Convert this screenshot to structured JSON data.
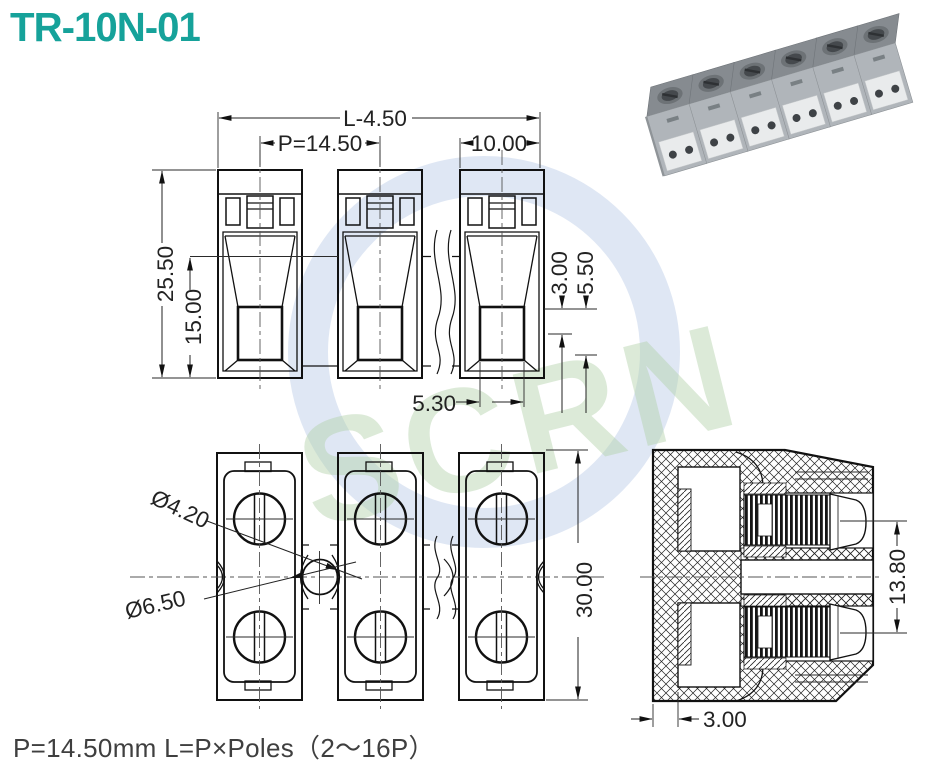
{
  "title": "TR-10N-01",
  "footer_note": "P=14.50mm  L=P×Poles（2～16P）",
  "watermark": {
    "text": "SCRN"
  },
  "front_view": {
    "dim_total_length": "L-4.50",
    "dim_pitch": "P=14.50",
    "dim_block_width": "10.00",
    "dim_overall_height": "25.50",
    "dim_body_height": "15.00",
    "dim_offset_a": "3.00",
    "dim_offset_b": "5.50",
    "dim_slot_width": "5.30"
  },
  "plan_view": {
    "dim_hole_dia": "Ø4.20",
    "dim_boss_dia": "Ø6.50",
    "dim_depth": "30.00"
  },
  "section_view": {
    "dim_screw_span": "13.80",
    "dim_wall_thickness": "3.00"
  },
  "colors": {
    "title_accent": "#16a29a",
    "drawing_line": "#111111",
    "note_text": "#3f3f3f",
    "watermark_blue": "#b0c4e4",
    "watermark_green": "#b2d1a8"
  }
}
